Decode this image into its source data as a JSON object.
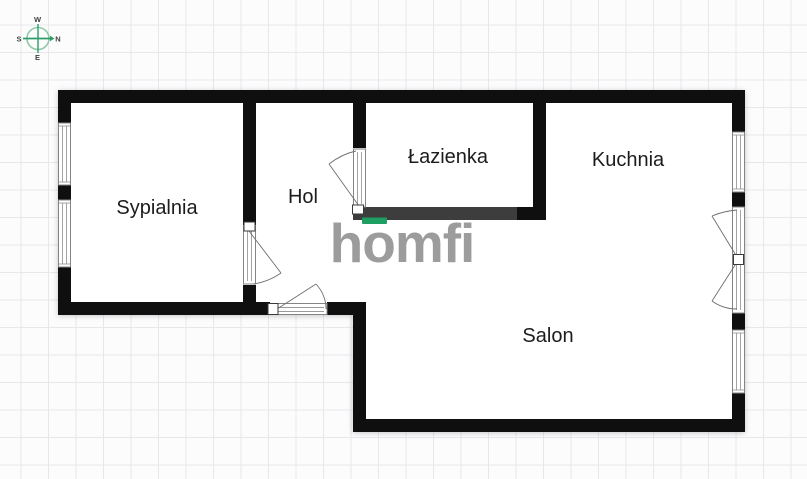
{
  "page": {
    "type": "apartment-floor-plan"
  },
  "compass": {
    "top": "W",
    "right": "N",
    "bottom": "E",
    "left": "S"
  },
  "rooms": [
    {
      "id": "sypialnia",
      "label": "Sypialnia"
    },
    {
      "id": "hol",
      "label": "Hol"
    },
    {
      "id": "lazienka",
      "label": "Łazienka"
    },
    {
      "id": "kuchnia",
      "label": "Kuchnia"
    },
    {
      "id": "salon",
      "label": "Salon"
    }
  ],
  "watermark": {
    "text": "homfi"
  },
  "colors": {
    "wall": "#0f0f0f",
    "wall_dark": "#3d3d3d",
    "brand_green": "#1e9e60",
    "logo_gray": "#9c9c9c",
    "grid_line": "#e8e8eb",
    "background": "#fcfcfd",
    "label_text": "#1c1c1c",
    "compass_green": "#2f9d68",
    "compass_circle": "#8fcaa8"
  }
}
